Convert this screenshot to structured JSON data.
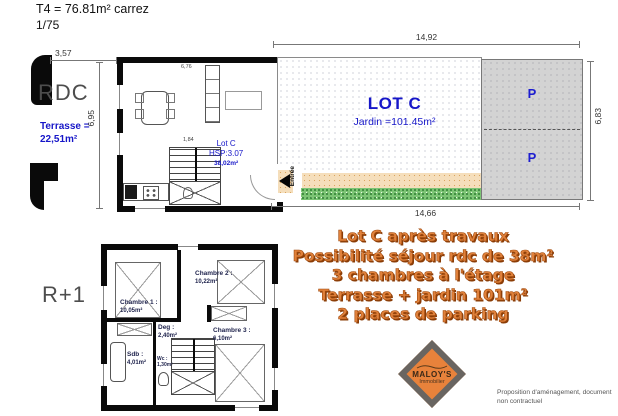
{
  "header": {
    "title": "T4 = 76.81m² carrez",
    "scale": "1/75"
  },
  "floors": {
    "rdc_label": "RDC",
    "r1_label": "R+1"
  },
  "terrace": {
    "line1": "Terrasse =",
    "line2": "22,51m²"
  },
  "rdc_room": {
    "name": "Lot C",
    "hsp": "HSP:3.07",
    "area": "38,02m²"
  },
  "rdc_dims": {
    "width_top": "6,76",
    "stair_width": "1,84"
  },
  "site": {
    "lot_title": "LOT C",
    "garden_label": "Jardin =101.45m²",
    "parking_label": "P",
    "entrance_label": "Entrée"
  },
  "dimensions": {
    "top": "14,92",
    "right": "6,83",
    "bottom": "14,66",
    "terrace_width": "3,57",
    "house_depth": "6,95"
  },
  "r1_rooms": {
    "ch1_name": "Chambre 1 :",
    "ch1_area": "10,05m²",
    "ch2_name": "Chambre 2 :",
    "ch2_area": "10,22m²",
    "ch3_name": "Chambre 3 :",
    "ch3_area": "6,10m²",
    "deg_name": "Deg :",
    "deg_area": "2,40m²",
    "sdb_name": "Sdb :",
    "sdb_area": "4,01m²",
    "wc_name": "Wc :",
    "wc_area": "1,30m²"
  },
  "promo": {
    "lines": [
      "Lot C après travaux",
      "Possibilité séjour rdc de 38m²",
      "3 chambres à l'étage",
      "Terrasse + jardin 101m²",
      "2 places de parking"
    ],
    "color": "#e0813b"
  },
  "logo": {
    "name": "MALOY'S",
    "subtitle": "Immobilier"
  },
  "footer": {
    "line1": "Proposition d'aménagement, document",
    "line2": "non contractuel"
  },
  "colors": {
    "blue": "#1616c8",
    "orange": "#e0813b",
    "parking_gray": "#d3d3d3"
  }
}
